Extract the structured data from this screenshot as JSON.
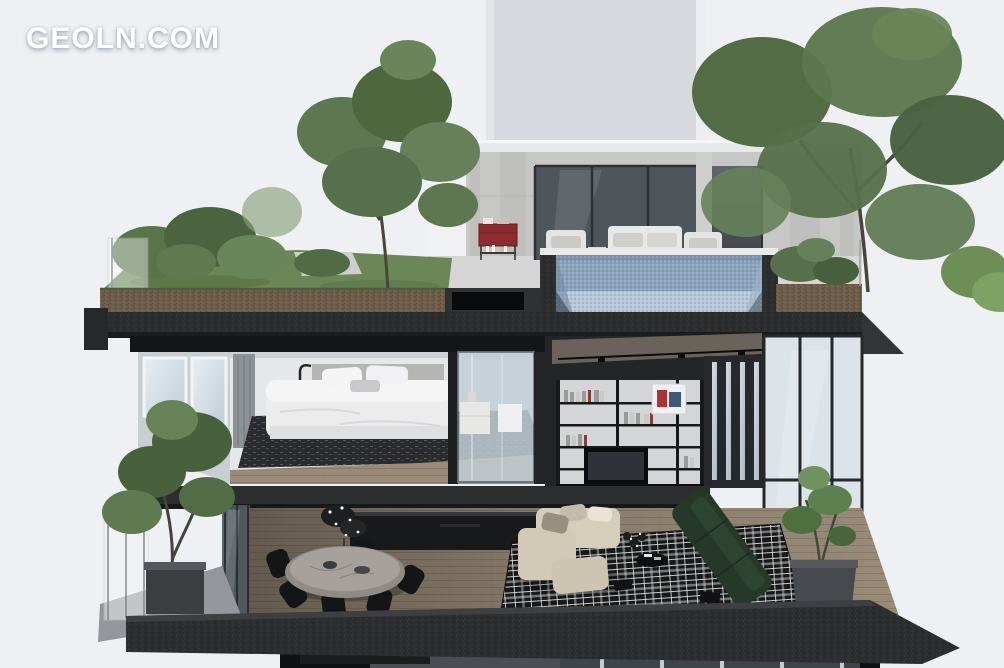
{
  "watermark": {
    "text": "GEOLN.COM"
  },
  "scene": {
    "type": "architectural-cutaway-render",
    "subject": "Cross-section of a modern multi-level penthouse with rooftop garden and pool",
    "levels": [
      {
        "name": "rooftop",
        "objects": [
          "roof-garden-grass",
          "garden-trees",
          "glass-railing",
          "penthouse-volume",
          "sliding-glass-doors",
          "outdoor-sofa",
          "outdoor-armchairs",
          "red-bar-cart",
          "plunge-pool-cross-section",
          "roof-planter-tree",
          "soil-layer"
        ]
      },
      {
        "name": "upper-floor",
        "objects": [
          "bedroom",
          "double-bed",
          "pillows",
          "dark-area-rug",
          "floor-lamp",
          "curtain",
          "window-band",
          "glass-bathroom-pod",
          "white-vanity",
          "double-height-library",
          "bookshelves",
          "tv",
          "art-frame",
          "track-lighting",
          "tall-glazing"
        ]
      },
      {
        "name": "main-floor",
        "objects": [
          "balcony-glass-railing",
          "balcony-planter-tree",
          "dining-table-oval-marble",
          "black-dining-chairs",
          "kitchen-island",
          "plant-centerpiece",
          "plaid-rug",
          "cream-modular-sofa",
          "green-sofa",
          "corner-plant-planter",
          "wood-flooring"
        ]
      },
      {
        "name": "lower-floor-glimpse",
        "objects": [
          "concrete-slab-edge",
          "lower-windows",
          "dark-interior"
        ]
      }
    ]
  },
  "colors": {
    "background": "#eef0f3",
    "tower": "#d6d9de",
    "concrete_wall": "#c7c7c5",
    "dark_glass": "#4e565c",
    "pool_water": "#8aa2ba",
    "pool_floor": "#b6c9d8",
    "pool_coping": "#e9eae9",
    "grass": "#6b8657",
    "soil": "#6e5d4b",
    "slab": "#2c2d2f",
    "bedroom_wall": "#e6e7e9",
    "duvet": "#ececed",
    "bedroom_rug": "#2a2b2e",
    "wood_floor": "#9a8b79",
    "library_wall": "#232528",
    "shelf_panel": "#d4d5d7",
    "window_glass": "#dce3e9",
    "kitchen": "#18191b",
    "table_marble": "#a6a29b",
    "plaid_rug_base": "#17181a",
    "sofa_cream": "#d6cdbb",
    "sofa_green": "#263829",
    "planter": "#46494d",
    "cart_red": "#8f2b2e",
    "foliage_dark": "#48613d",
    "foliage_mid": "#5d7850",
    "foliage_light": "#6a8559"
  }
}
